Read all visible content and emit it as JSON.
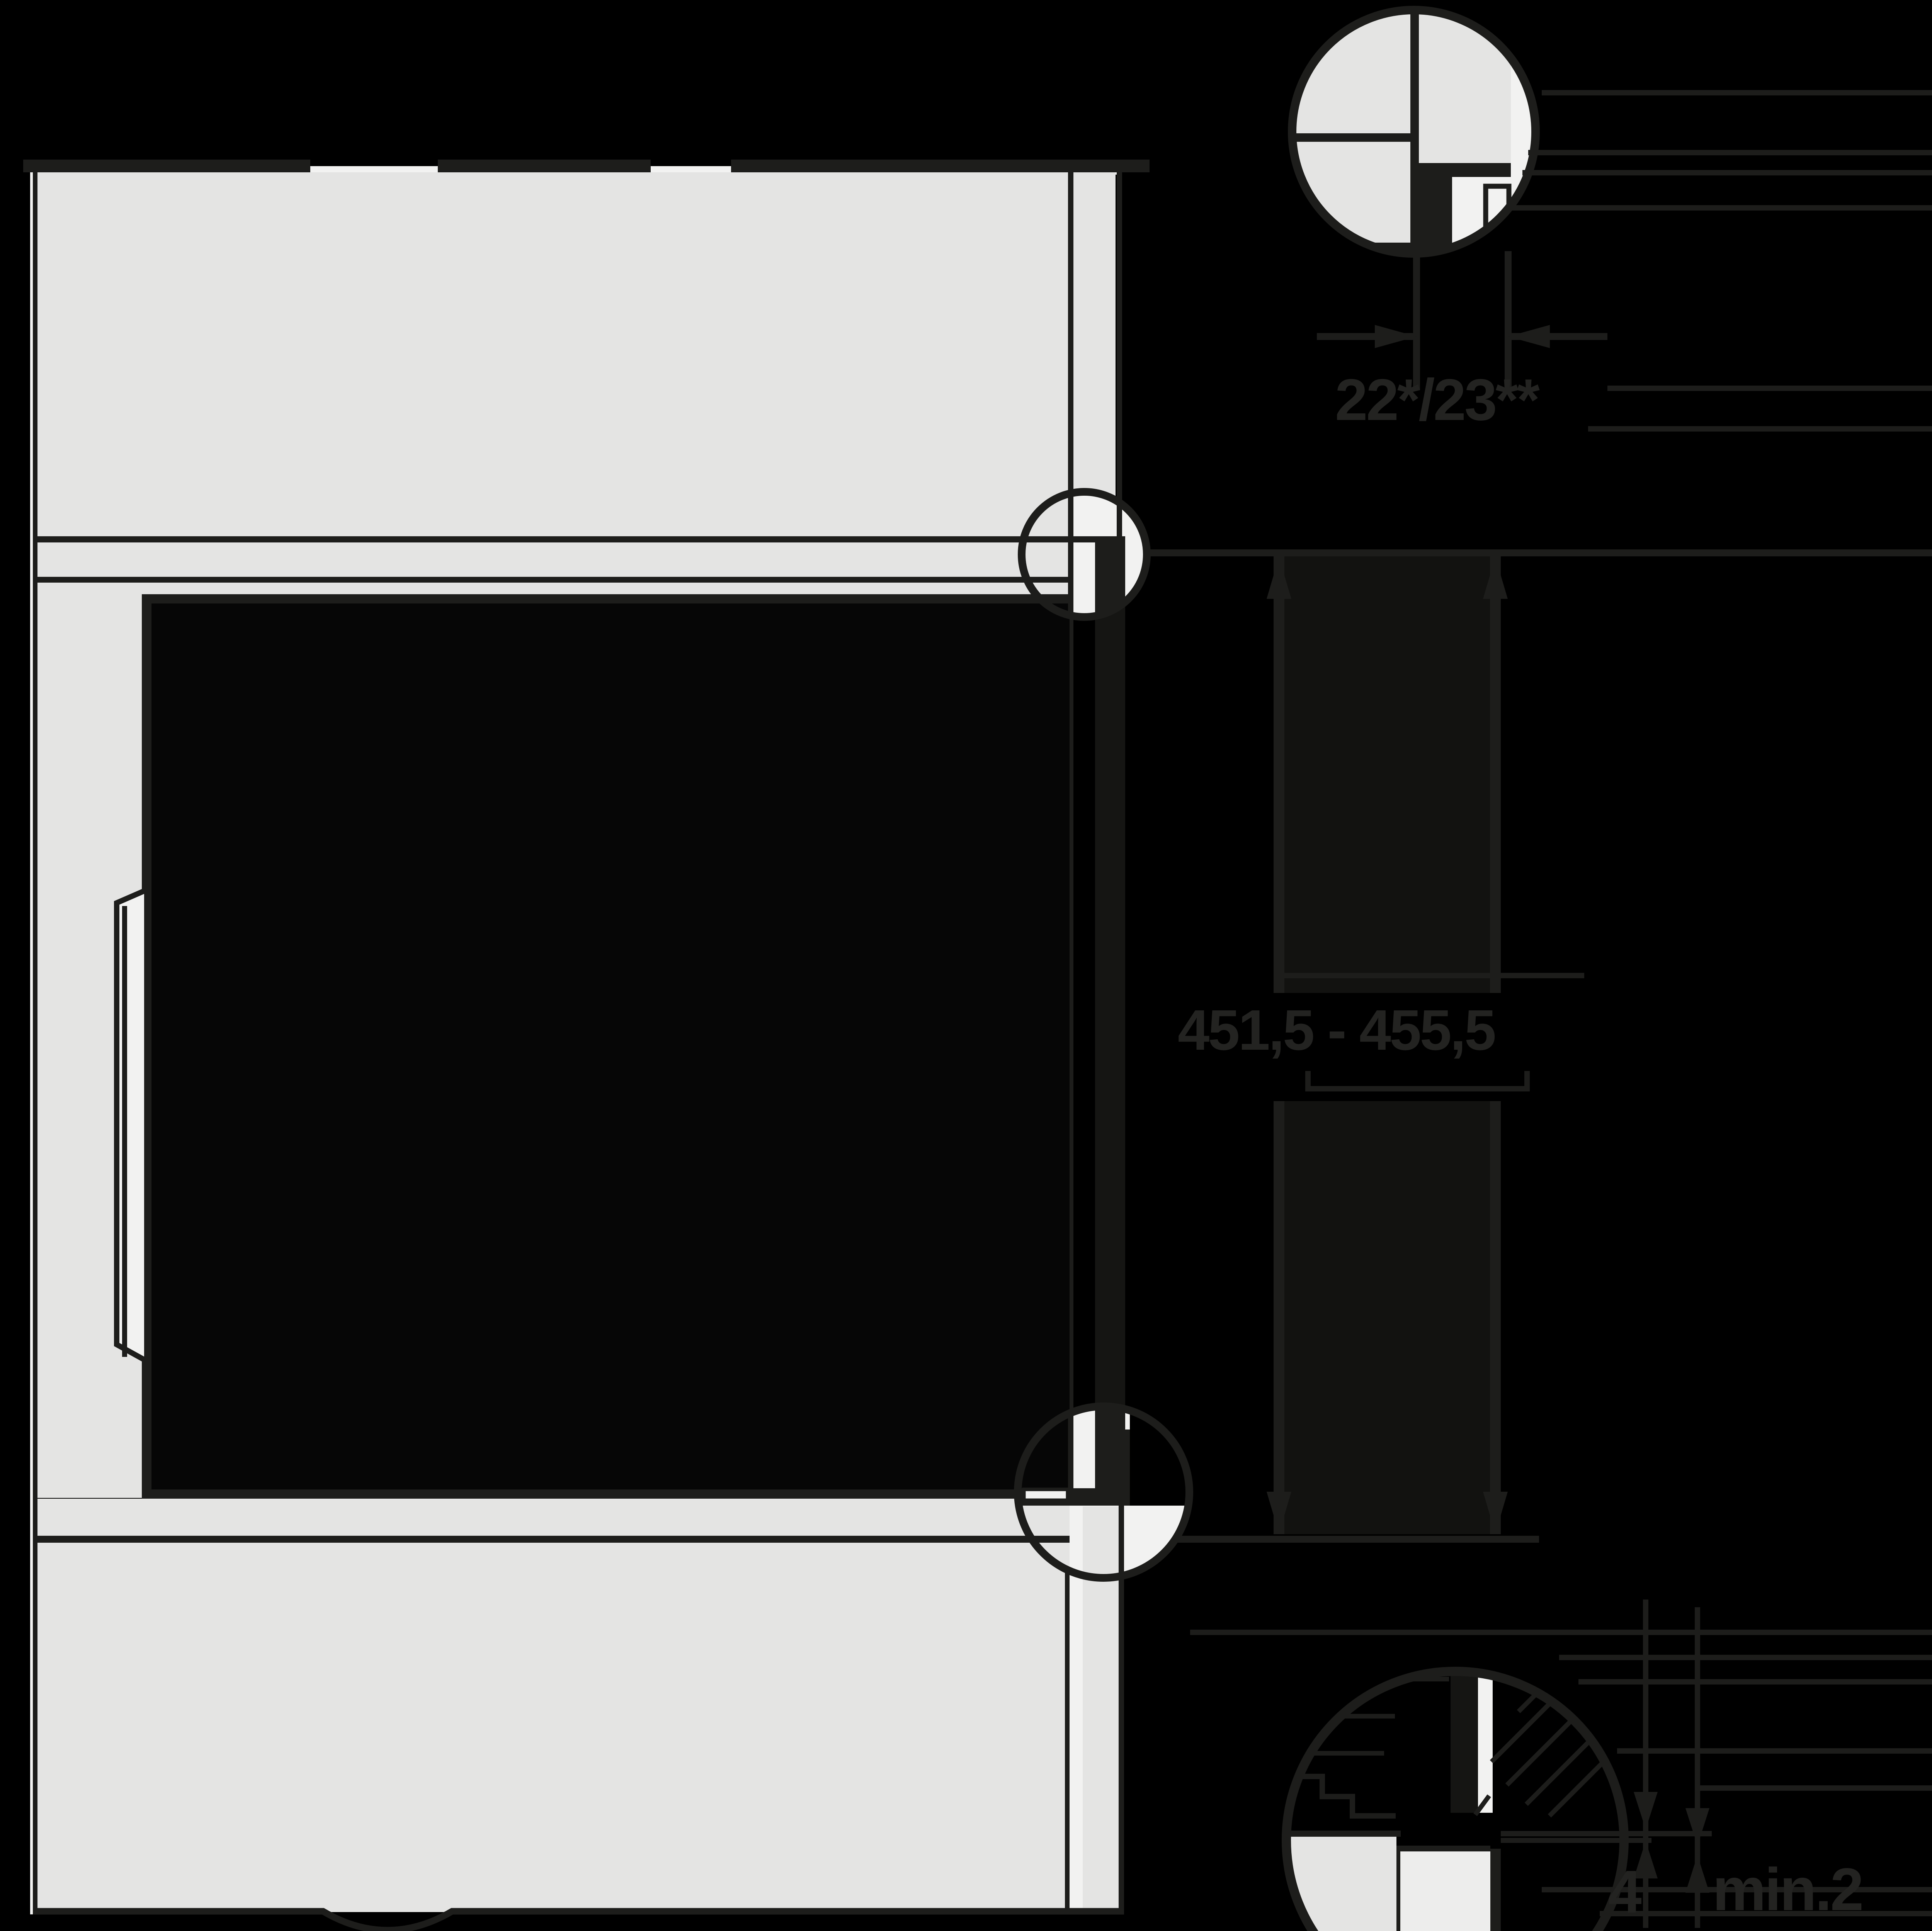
{
  "diagram": {
    "title": "built-in appliance installation side section",
    "labels": {
      "overlay_thickness": "22*/23**",
      "niche_height_range": "451,5 - 455,5",
      "bottom_gap": "4",
      "min_clearance": "min.2"
    },
    "colors": {
      "background": "#000000",
      "line": "#1d1d1b",
      "panel_gray": "#e4e4e3",
      "detail_white": "#f2f2f1",
      "bar_fill": "#141412"
    }
  }
}
